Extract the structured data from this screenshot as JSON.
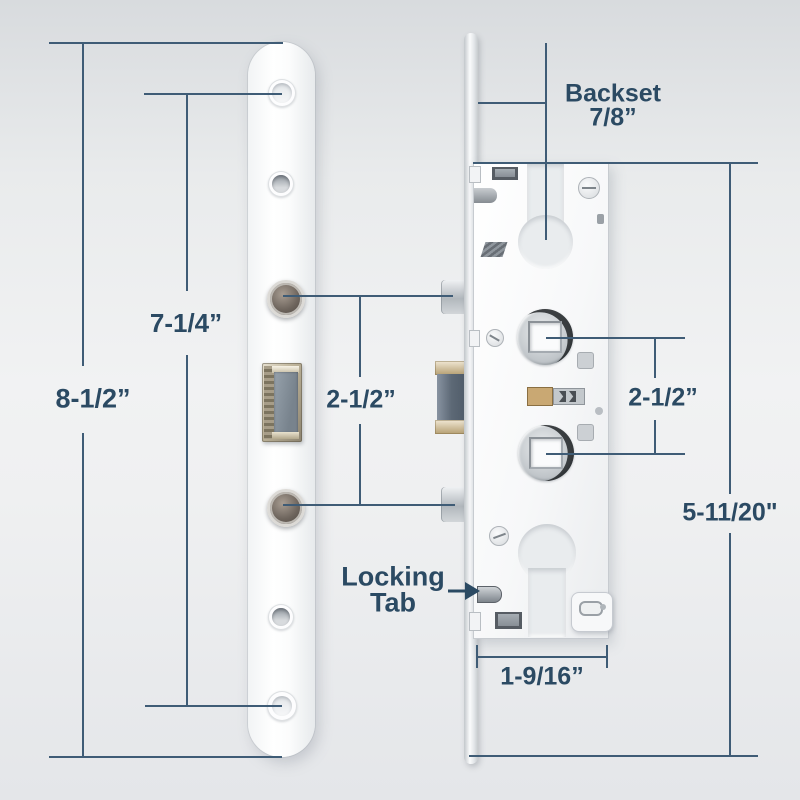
{
  "colors": {
    "line": "#3f5c76",
    "text": "#2b4a63"
  },
  "diagram": {
    "plate_height": "8-1/2”",
    "hole_spacing": "7-1/4”",
    "bolt_spacing_left": "2-1/2”",
    "backset_label": "Backset",
    "backset_value": "7/8”",
    "hub_spacing_right": "2-1/2”",
    "case_height": "5-11/20\"",
    "case_width": "1-9/16”",
    "locking_tab_line1": "Locking",
    "locking_tab_line2": "Tab"
  }
}
